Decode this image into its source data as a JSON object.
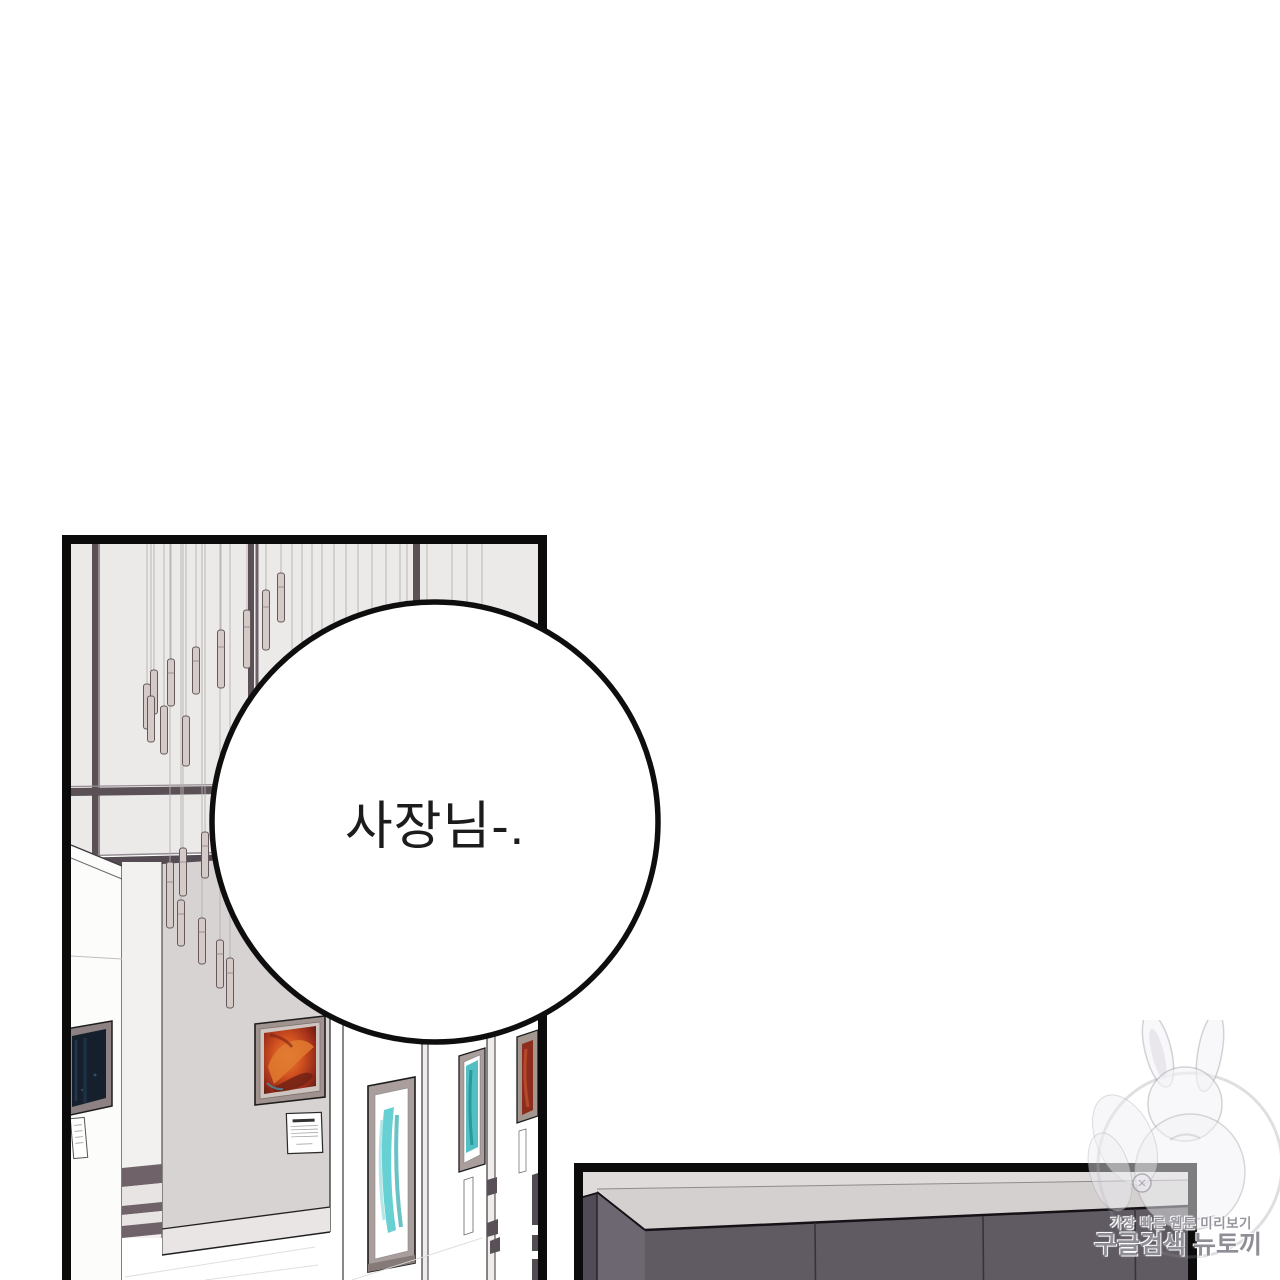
{
  "page": {
    "background": "#ffffff",
    "type": "webtoon-page"
  },
  "gallery_panel": {
    "description": "art gallery interior with pendant lights, window mullions and framed paintings",
    "speech_bubble": {
      "text": "사장님-."
    }
  },
  "counter_panel": {
    "description": "dark kitchen counter corner against light wall"
  },
  "watermark": {
    "line1": "가장 빠른 웹툰 미리보기",
    "line2": "구글검색 뉴토끼",
    "mascot": "bunny-girl-emblem"
  },
  "colors": {
    "panel_border": "#0b0b0b",
    "window_glass": "#eceae8",
    "mullion_dark": "#5a5056",
    "wall_gray": "#d7d3d2",
    "wall_white": "#fcfcfb",
    "pendant_body": "#d4cac7",
    "frame_taupe": "#a99e9b",
    "art_red_swirl": "#c54a21",
    "art_teal": "#57cbcd",
    "art_dark_navy": "#15202c",
    "cabinet_dark": "#605b63",
    "counter_wall": "#dedbda",
    "watermark_gray": "#8b888d",
    "bubble_fill": "#ffffff",
    "bubble_stroke": "#0e0e0e"
  }
}
